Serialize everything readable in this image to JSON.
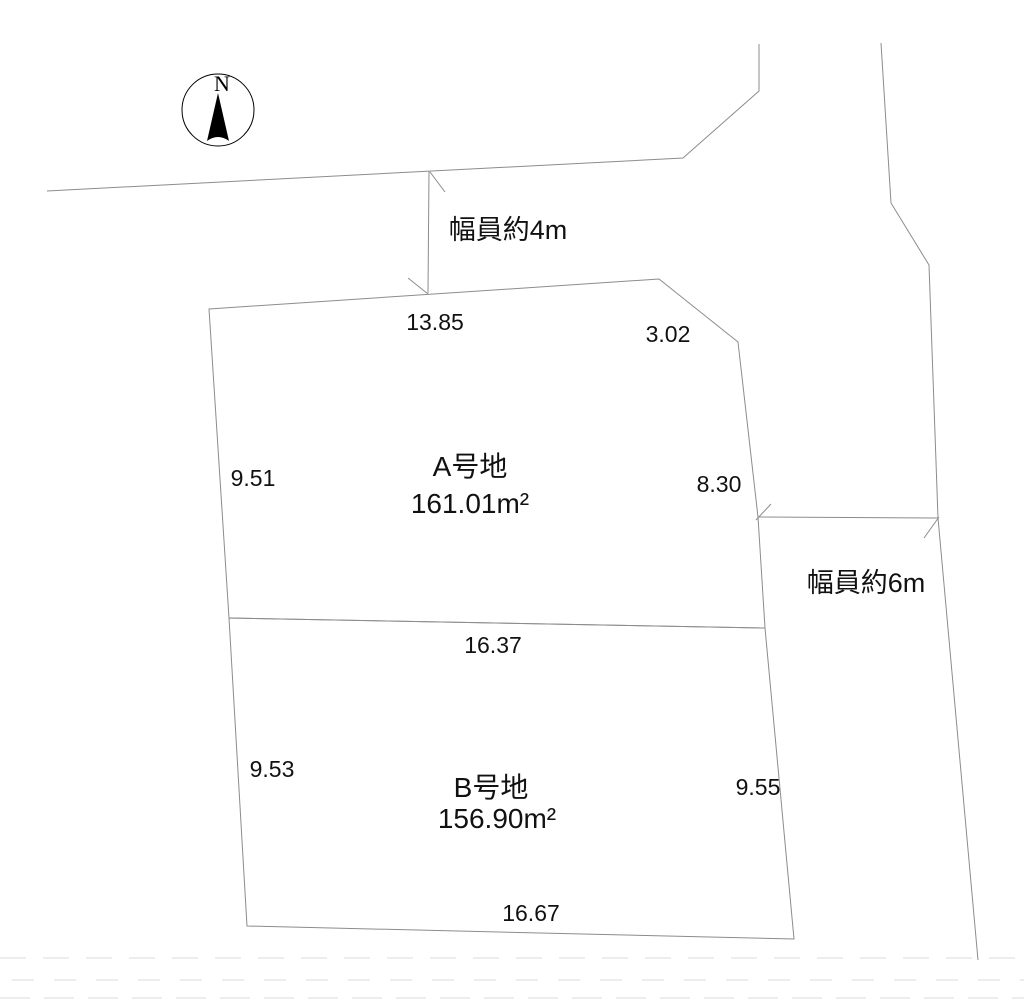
{
  "compass": {
    "north_label": "N"
  },
  "roads": {
    "north_road_width_label": "幅員約4m",
    "east_road_width_label": "幅員約6m"
  },
  "plots": {
    "a": {
      "name": "A号地",
      "area": "161.01m²",
      "dimensions": {
        "top": "13.85",
        "corner": "3.02",
        "left": "9.51",
        "right": "8.30"
      }
    },
    "b": {
      "name": "B号地",
      "area": "156.90m²",
      "dimensions": {
        "top": "16.37",
        "left": "9.53",
        "right": "9.55",
        "bottom": "16.67"
      }
    }
  },
  "colors": {
    "background": "#ffffff",
    "line": "#8c8c8c",
    "text": "#111111",
    "compass": "#000000",
    "faint_dash": "#ededed"
  }
}
